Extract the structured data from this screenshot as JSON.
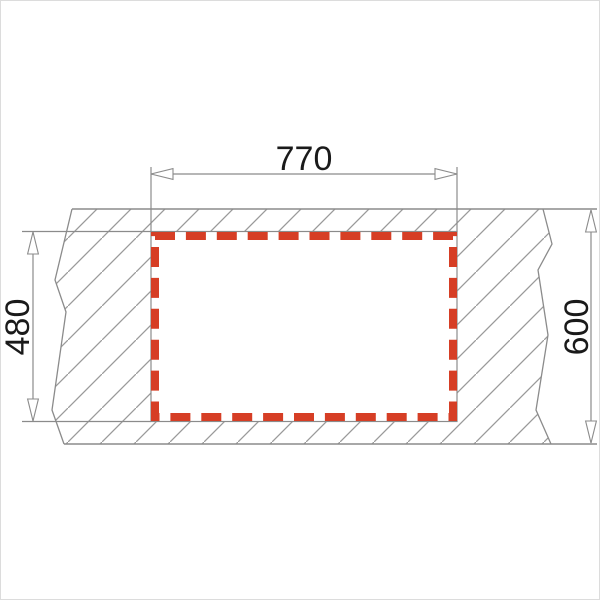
{
  "diagram": {
    "dimensions": {
      "cutout_width": {
        "label": "770"
      },
      "cutout_height": {
        "label": "480"
      },
      "worktop_depth": {
        "label": "600"
      }
    },
    "colors": {
      "cutout_highlight_red": "#d63e25",
      "drawing_line_gray": "#8b8b8b",
      "hatch_line_gray": "#9a9a9a",
      "text_black": "#1a1a1a",
      "background": "#ffffff"
    }
  }
}
